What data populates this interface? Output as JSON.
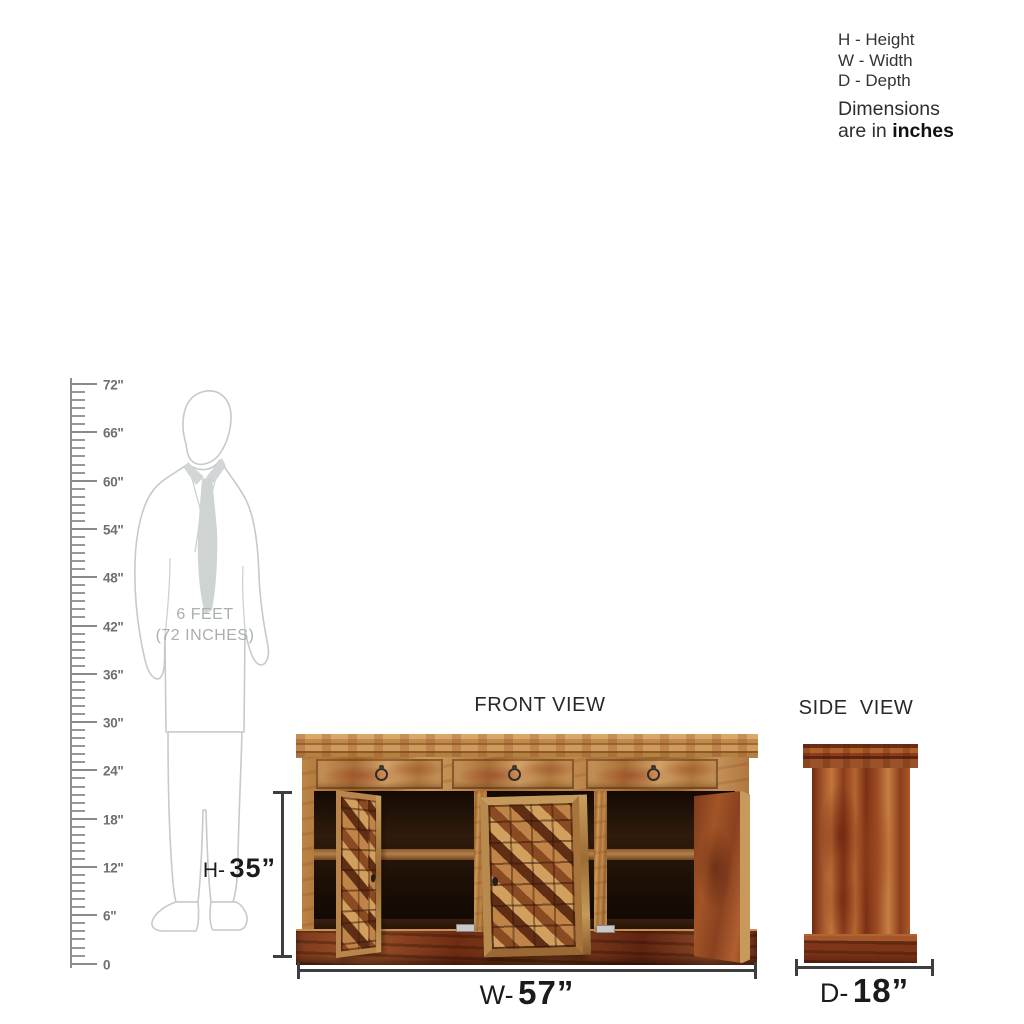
{
  "legend": {
    "items": [
      "H - Height",
      "W - Width",
      "D - Depth"
    ],
    "note_line1": "Dimensions",
    "note_line2_prefix": "are in ",
    "note_line2_bold": "inches"
  },
  "ruler": {
    "max_inches": 72,
    "major_step": 6,
    "labels": [
      "72\"",
      "66\"",
      "60\"",
      "54\"",
      "48\"",
      "42\"",
      "36\"",
      "30\"",
      "24\"",
      "18\"",
      "12\"",
      "6\"",
      "0"
    ]
  },
  "human_figure": {
    "caption_line1": "6 FEET",
    "caption_line2": "(72 INCHES)"
  },
  "front_view": {
    "title": "FRONT VIEW",
    "height_prefix": "H-",
    "height_value": "35”",
    "width_prefix": "W-",
    "width_value": "57”"
  },
  "side_view": {
    "title": "SIDE VIEW",
    "depth_prefix": "D-",
    "depth_value": "18”"
  },
  "colors": {
    "wood_light": "#bf8a4e",
    "wood_red": "#8a4420",
    "interior_dark": "#2a160b",
    "dimension_line": "#3e3e3e",
    "ruler_gray": "#8f8f8f",
    "figure_outline_gray": "#c6cacb",
    "text_dark": "#1b1b1b"
  }
}
